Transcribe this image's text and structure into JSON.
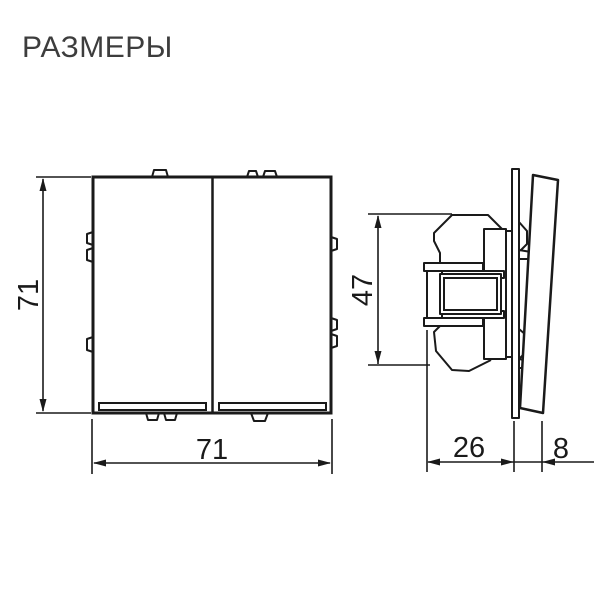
{
  "title": "РАЗМЕРЫ",
  "drawing": {
    "front_view": {
      "description": "front view of two-gang rocker switch",
      "height_label": "71",
      "width_label": "71"
    },
    "side_view": {
      "description": "side view of switch mechanism with frame and rocker",
      "height_label": "47",
      "depth_label": "26",
      "thickness_label": "8"
    }
  },
  "colors": {
    "line": "#1a1a1a",
    "title_text": "#3d3d3d",
    "background": "#ffffff"
  }
}
